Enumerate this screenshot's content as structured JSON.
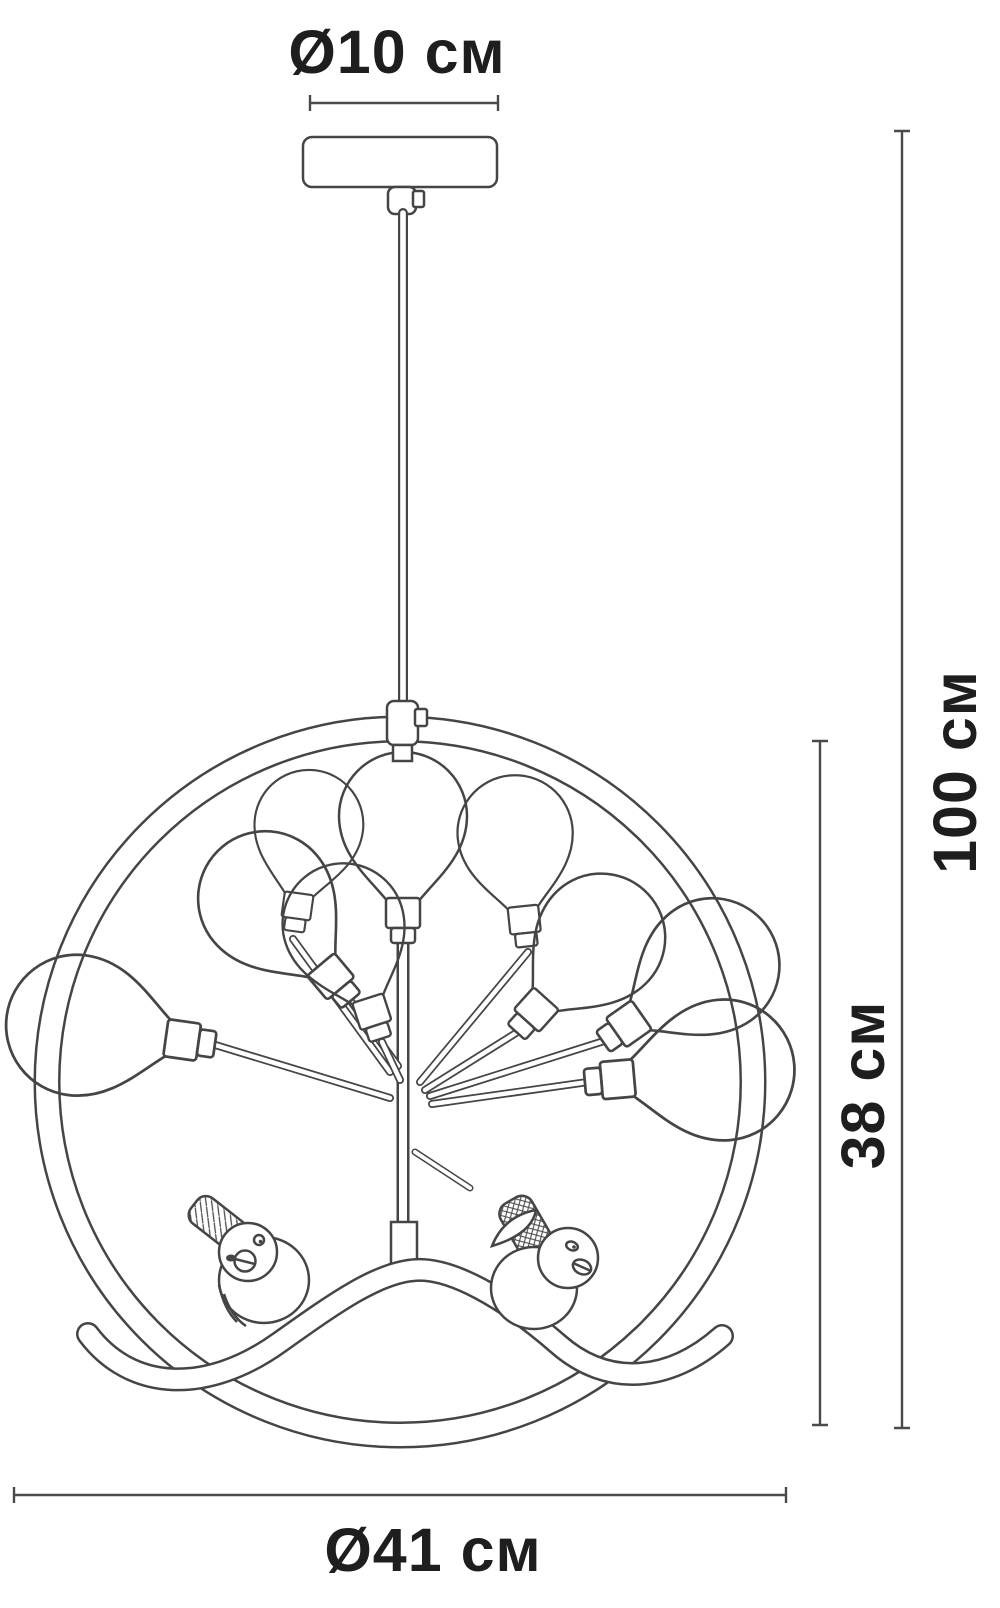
{
  "page": {
    "background": "#ffffff"
  },
  "diagram": {
    "kind": "product dimension line drawing",
    "product": "pendant chandelier: ring frame with tree branch arms, balloon glass bulbs and two bird figurines on a wavy perch",
    "bulb_count": 9,
    "bird_count": 2,
    "colors": {
      "line": "#454545",
      "dimension_line": "#4a4a4a",
      "text": "#1e1e1e",
      "background": "#ffffff"
    },
    "labels": {
      "canopy_diameter": "Ø10 см",
      "overall_height": "100 см",
      "fixture_height": "38 см",
      "fixture_diameter": "Ø41 см"
    }
  }
}
